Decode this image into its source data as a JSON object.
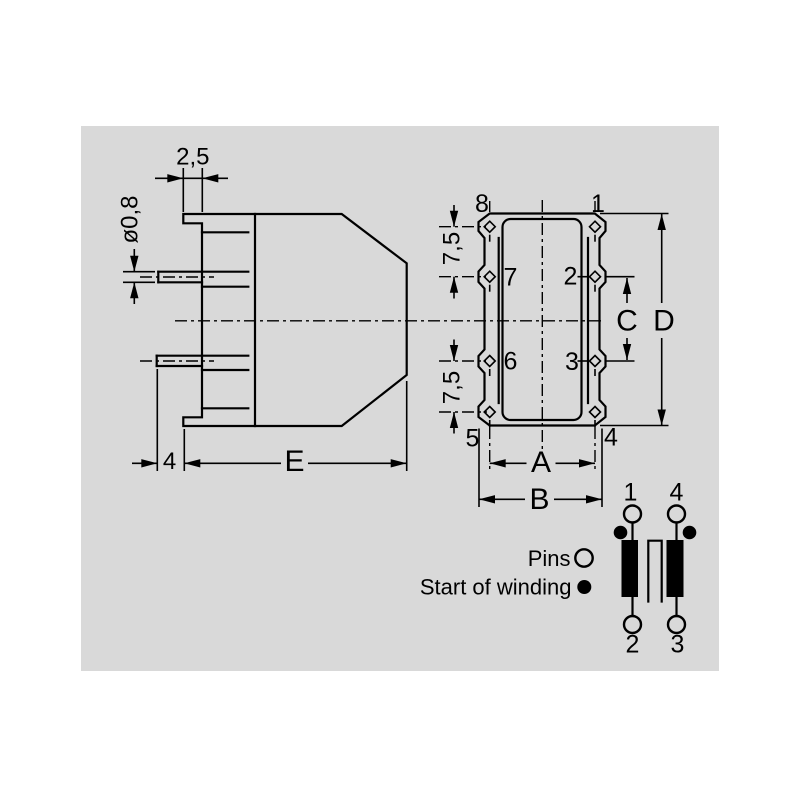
{
  "side_view": {
    "dim_flange_thickness": "2,5",
    "dim_pin_diameter": "ø0,8",
    "dim_pin_protrusion": "4",
    "dim_body_length": "E"
  },
  "top_view": {
    "pins": {
      "p8": "8",
      "p1": "1",
      "p7": "7",
      "p2": "2",
      "p6": "6",
      "p3": "3",
      "p5": "5",
      "p4": "4"
    },
    "dim_pitch_top": "7,5",
    "dim_pitch_bottom": "7,5",
    "dim_a": "A",
    "dim_b": "B",
    "dim_c": "C",
    "dim_d": "D"
  },
  "schematic": {
    "pins": {
      "top_left": "1",
      "top_right": "4",
      "bottom_left": "2",
      "bottom_right": "3"
    },
    "legend": {
      "pins_label": "Pins",
      "start_label": "Start of winding"
    }
  },
  "colors": {
    "panel": "#d9d9d9",
    "line": "#000000"
  }
}
